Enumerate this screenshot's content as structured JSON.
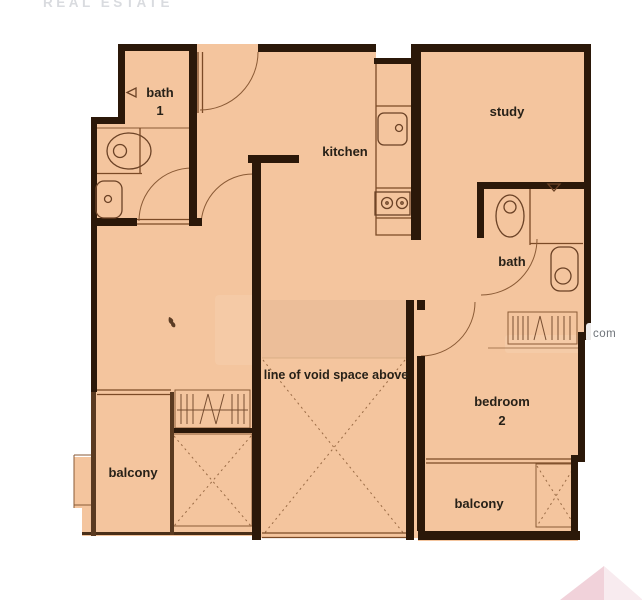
{
  "plan": {
    "labels": {
      "bath1_line1": "bath",
      "bath1_line2": "1",
      "kitchen": "kitchen",
      "study": "study",
      "bath2": "bath",
      "bedroom2_line1": "bedroom",
      "bedroom2_line2": "2",
      "balcony_left": "balcony",
      "balcony_right": "balcony",
      "void_note": "line of void space above"
    },
    "watermarks": {
      "top_left": "REAL ESTATE",
      "right_edge": "com"
    },
    "colors": {
      "background": "#ffffff",
      "floor": "#f4c59e",
      "wall": "#2b1809",
      "line": "#7b4a26",
      "label": "#272118",
      "watermark_gray": "#d9dbdf",
      "logo_pink_left": "#f1d2da",
      "logo_pink_right": "#f8ebef"
    }
  }
}
